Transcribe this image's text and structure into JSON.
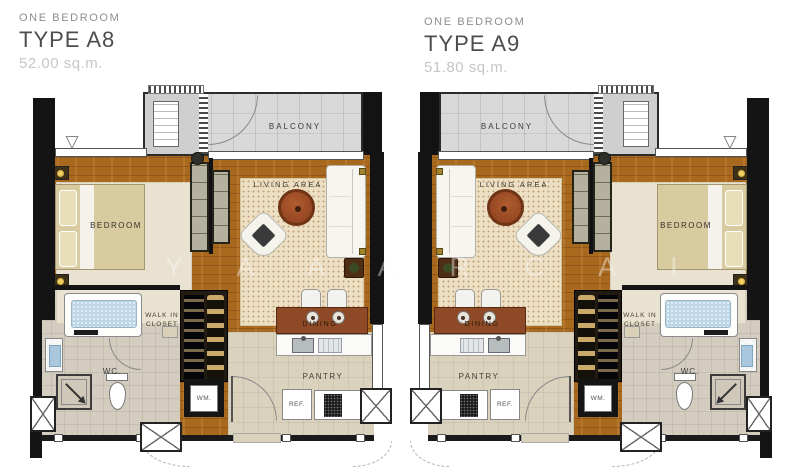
{
  "watermark": {
    "text": "Y A A A R C A I"
  },
  "symbols": {
    "window_marker": "▽"
  },
  "colors": {
    "wood_floor": "#a8691f",
    "balcony_tile": "#d9d9d9",
    "wall": "#141414",
    "living_rug": "#ecdfc4",
    "coffee_table": "#8a3e1c",
    "dining_table": "#8e4a26",
    "bathtub": "#bdd7e7",
    "title_type": "#4d4d4d",
    "title_area": "#c6c6c6"
  },
  "plans": [
    {
      "header": {
        "category": "ONE BEDROOM",
        "type": "TYPE A8",
        "area": "52.00 sq.m."
      },
      "rooms": {
        "balcony": "BALCONY",
        "living_area": "LIVING AREA",
        "bedroom": "BEDROOM",
        "walk_in_closet": [
          "WALK IN",
          "CLOSET"
        ],
        "wc": "WC.",
        "dining": "DINING",
        "pantry": "PANTRY",
        "refrigerator": "REF.",
        "washing_machine": "WM."
      }
    },
    {
      "header": {
        "category": "ONE BEDROOM",
        "type": "TYPE A9",
        "area": "51.80 sq.m."
      },
      "rooms": {
        "balcony": "BALCONY",
        "living_area": "LIVING AREA",
        "bedroom": "BEDROOM",
        "walk_in_closet": [
          "WALK IN",
          "CLOSET"
        ],
        "wc": "WC.",
        "dining": "DINING",
        "pantry": "PANTRY",
        "refrigerator": "REF.",
        "washing_machine": "WM."
      }
    }
  ]
}
